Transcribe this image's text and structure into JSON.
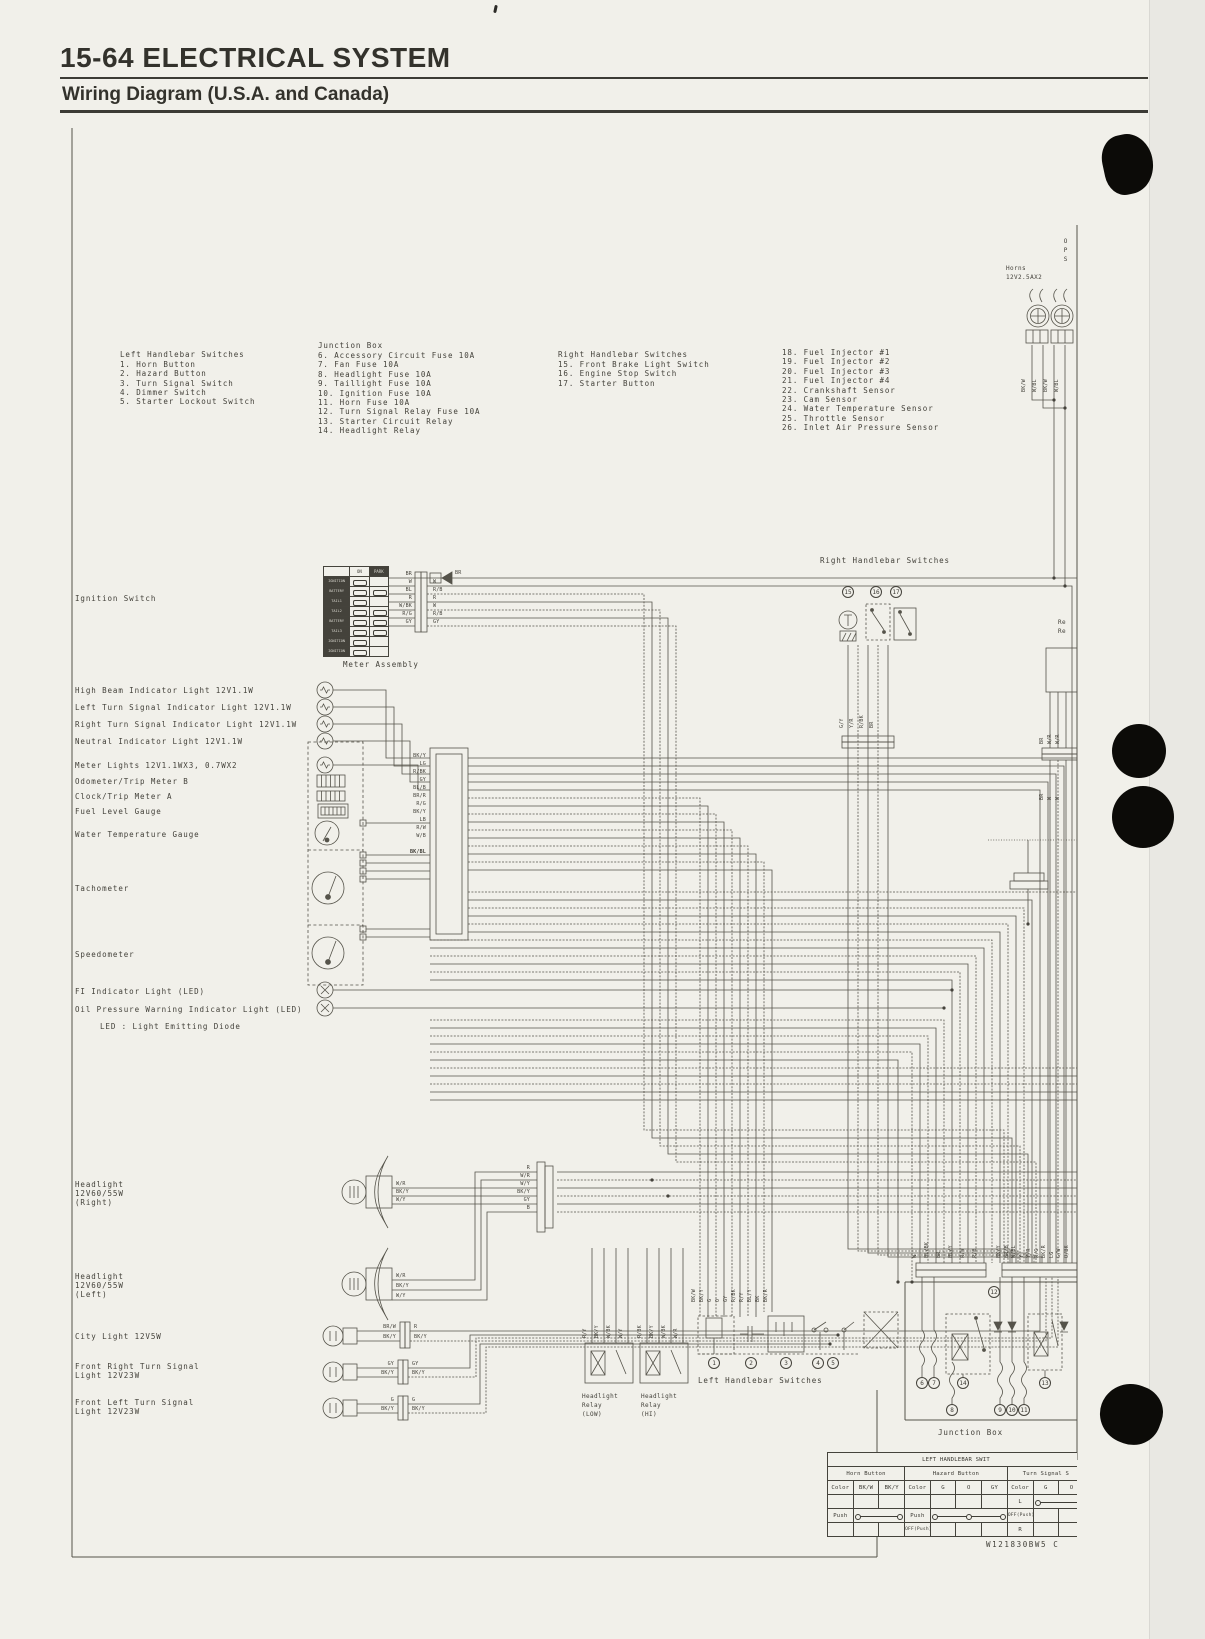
{
  "header": {
    "page_title": "15-64 ELECTRICAL SYSTEM",
    "subtitle": "Wiring Diagram (U.S.A. and Canada)"
  },
  "legend": {
    "col1": {
      "title": "Left Handlebar Switches",
      "items": [
        "1. Horn Button",
        "2. Hazard Button",
        "3. Turn Signal Switch",
        "4. Dimmer Switch",
        "5. Starter Lockout Switch"
      ]
    },
    "col2": {
      "title": "Junction Box",
      "items": [
        "6. Accessory Circuit Fuse 10A",
        "7. Fan Fuse 10A",
        "8. Headlight Fuse 10A",
        "9. Taillight Fuse 10A",
        "10. Ignition Fuse 10A",
        "11. Horn Fuse 10A",
        "12. Turn Signal Relay Fuse 10A",
        "13. Starter Circuit Relay",
        "14. Headlight Relay"
      ]
    },
    "col3": {
      "title": "Right Handlebar Switches",
      "items": [
        "15. Front Brake Light Switch",
        "16. Engine Stop Switch",
        "17. Starter Button"
      ]
    },
    "col4": {
      "items": [
        "18. Fuel Injector #1",
        "19. Fuel Injector #2",
        "20. Fuel Injector #3",
        "21. Fuel Injector #4",
        "22. Crankshaft Sensor",
        "23. Cam Sensor",
        "24. Water Temperature Sensor",
        "25. Throttle Sensor",
        "26. Inlet Air Pressure Sensor"
      ]
    }
  },
  "labels": {
    "ignition_switch": "Ignition Switch",
    "meter_assembly": "Meter Assembly",
    "high_beam": "High Beam Indicator Light 12V1.1W",
    "left_turn": "Left Turn Signal Indicator Light 12V1.1W",
    "right_turn": "Right Turn Signal Indicator Light 12V1.1W",
    "neutral": "Neutral Indicator Light 12V1.1W",
    "meter_lights": "Meter Lights 12V1.1WX3, 0.7WX2",
    "odometer": "Odometer/Trip Meter B",
    "clock": "Clock/Trip Meter A",
    "fuel_gauge": "Fuel Level Gauge",
    "water_temp": "Water Temperature Gauge",
    "tachometer": "Tachometer",
    "speedometer": "Speedometer",
    "fi_light": "FI Indicator Light (LED)",
    "oil_light": "Oil Pressure Warning Indicator Light (LED)",
    "led_note": "LED : Light Emitting Diode",
    "rhb_mid": "Right Handlebar Switches",
    "horns_1": "Horns",
    "horns_2": "12V2.5AX2",
    "ops": "OPS",
    "re_1": "Re",
    "re_2": "Re",
    "hl_right": [
      "Headlight",
      "12V60/55W",
      "(Right)"
    ],
    "hl_left": [
      "Headlight",
      "12V60/55W",
      "(Left)"
    ],
    "city": "City Light 12V5W",
    "ts_right": [
      "Front Right Turn Signal",
      "Light 12V23W"
    ],
    "ts_left": [
      "Front Left Turn Signal",
      "Light 12V23W"
    ],
    "relay_low": [
      "Headlight",
      "Relay",
      "(LOW)"
    ],
    "relay_hi": [
      "Headlight",
      "Relay",
      "(HI)"
    ],
    "lhb_bottom": "Left Handlebar Switches",
    "junction_bottom": "Junction Box"
  },
  "ign_block": {
    "on": "ON",
    "park": "PARK",
    "rows": [
      "IGNITION",
      "BATTERY",
      "TAIL1",
      "TAIL2",
      "BATTERY",
      "TAIL3",
      "IGNITION",
      "IGNITION"
    ]
  },
  "wires": {
    "ig_l": [
      "BR",
      "W",
      "BL",
      "R",
      "W/BK",
      "R/G",
      "GY"
    ],
    "ig_r": [
      "BR",
      "W",
      "R/B",
      "R",
      "W",
      "R/B",
      "GY"
    ],
    "meter": [
      "BK/Y",
      "LG",
      "R/BK",
      "GY",
      "BL/B",
      "BR/R",
      "R/G",
      "BK/Y",
      "LB",
      "R/W",
      "W/B",
      "BK/BL"
    ],
    "horns": [
      "BK/W",
      "W/BL",
      "BK/W",
      "W/BL"
    ],
    "lhb": [
      "BK/W",
      "BK/Y",
      "G",
      "O",
      "GY",
      "R/BK",
      "R/Y",
      "BL/Y",
      "BK",
      "BK/R"
    ],
    "relay_low": [
      "R/Y",
      "BK/Y",
      "W/BK",
      "W/Y"
    ],
    "relay_hi": [
      "R/BK",
      "BK/Y",
      "W/BK",
      "W/R"
    ],
    "jb_left": [
      "W",
      "BL/BK",
      "BR",
      "BL/Y",
      "R/W",
      "R/B"
    ],
    "jb_right": [
      "BK/Y",
      "BR/B",
      "W/BL",
      "Y",
      "Y/R",
      "R/G",
      "BK/R",
      "LG",
      "G/W",
      "O/BK"
    ],
    "rhb": [
      "G/Y",
      "Y/R",
      "R/BK",
      "BR"
    ],
    "re_top": [
      "BR",
      "W/R",
      "W/R"
    ],
    "re_bot": [
      "BR",
      "W",
      "W"
    ],
    "hl_bulb_r": [
      "W/R",
      "BK/Y",
      "W/Y"
    ],
    "hl_bulb_l": [
      "W/R",
      "BK/Y",
      "W/Y"
    ],
    "hl_conn": [
      "R",
      "W/R",
      "W/Y",
      "BK/Y",
      "GY",
      "B"
    ],
    "city": [
      "BR/W",
      "BK/Y",
      "R",
      "BK/Y"
    ],
    "ts_r": [
      "GY",
      "BK/Y",
      "GY",
      "BK/Y"
    ],
    "ts_l": [
      "G",
      "BK/Y",
      "G",
      "BK/Y"
    ]
  },
  "circled": {
    "c1": "1",
    "c2": "2",
    "c3": "3",
    "c4": "4",
    "c5": "5",
    "c6": "6",
    "c7": "7",
    "c8": "8",
    "c9": "9",
    "c10": "10",
    "c11": "11",
    "c12": "12",
    "c13": "13",
    "c14": "14",
    "c15": "15",
    "c16": "16",
    "c17": "17"
  },
  "table": {
    "title": "LEFT HANDLEBAR SWIT",
    "horn": "Horn Button",
    "hazard": "Hazard Button",
    "turn": "Turn Signal S",
    "color": "Color",
    "horn_cols": [
      "BK/W",
      "BK/Y"
    ],
    "hazard_cols": [
      "G",
      "O",
      "GY"
    ],
    "turn_cols": [
      "G",
      "O"
    ],
    "push": "Push",
    "off_push": "OFF(Push)",
    "l": "L",
    "r": "R"
  },
  "footer": {
    "part_number": "W121830BW5 C"
  }
}
